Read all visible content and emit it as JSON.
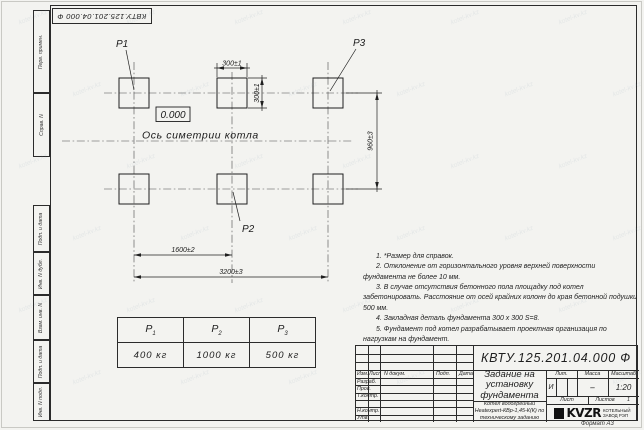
{
  "watermark": {
    "text": "kotel-kv.kz"
  },
  "margin": {
    "top_stamp": "КВТУ.125.201.04.000  Ф",
    "cells_top": [
      "Перв. примен.",
      "Справ. N"
    ],
    "cells_bottom": [
      "Подп. и дата",
      "Инв. N дубл.",
      "Взам. инв. N",
      "Подп. и дата",
      "Инв. N подл."
    ]
  },
  "drawing": {
    "labels": {
      "p1": "P1",
      "p2": "P2",
      "p3": "P3"
    },
    "elevation": "0.000",
    "axis_label": "Ось симетрии котла",
    "dimensions": {
      "pad_width": "300±1",
      "pad_height": "300±1",
      "row_spacing": "960±3",
      "half_span": "1600±2",
      "full_span": "3200±3"
    }
  },
  "load_table": {
    "cols": [
      {
        "h": "P",
        "s": "1",
        "v": "400 кг"
      },
      {
        "h": "P",
        "s": "2",
        "v": "1000 кг"
      },
      {
        "h": "P",
        "s": "3",
        "v": "500 кг"
      }
    ]
  },
  "notes": [
    "1. *Размер для справок.",
    "2. Отклонение от горизонтального уровня верхней поверхности фундамента не более 10 мм.",
    "3. В случае отсутствия бетонного пола площадку под котел забетонировать. Расстояние от осей крайних колонн до края бетонной подушки 500 мм.",
    "4. Закладная деталь фундамента  300 х 300  S=8.",
    "5. Фундамент под котел разрабатывает проектная организация по нагрузкам на фундамент."
  ],
  "title_block": {
    "designation": "КВТУ.125.201.04.000  Ф",
    "doc_title": "Задание на установку фундамента",
    "product": "Котел водогрейный Heatexpert-КВр-1,45-К(К) по техническому заданию",
    "header_cols": [
      "Изм.",
      "Лист",
      "N докум.",
      "Подп.",
      "Дата"
    ],
    "rows": [
      "Разраб.",
      "Пров.",
      "Т.контр.",
      "",
      "Н.контр.",
      "Утв."
    ],
    "lit_label": "Лит.",
    "mass_label": "Масса",
    "scale_label": "Масштаб",
    "lit_value": "И",
    "mass_value": "–",
    "scale_value": "1:20",
    "sheet_label": "Лист",
    "sheets_label": "Листов",
    "sheets_value": "1",
    "logo_word": "KVZR",
    "logo_caption_1": "КОТЕЛЬНЫЙ",
    "logo_caption_2": "ЗАВОД РЭП",
    "format_label": "Формат А3"
  }
}
